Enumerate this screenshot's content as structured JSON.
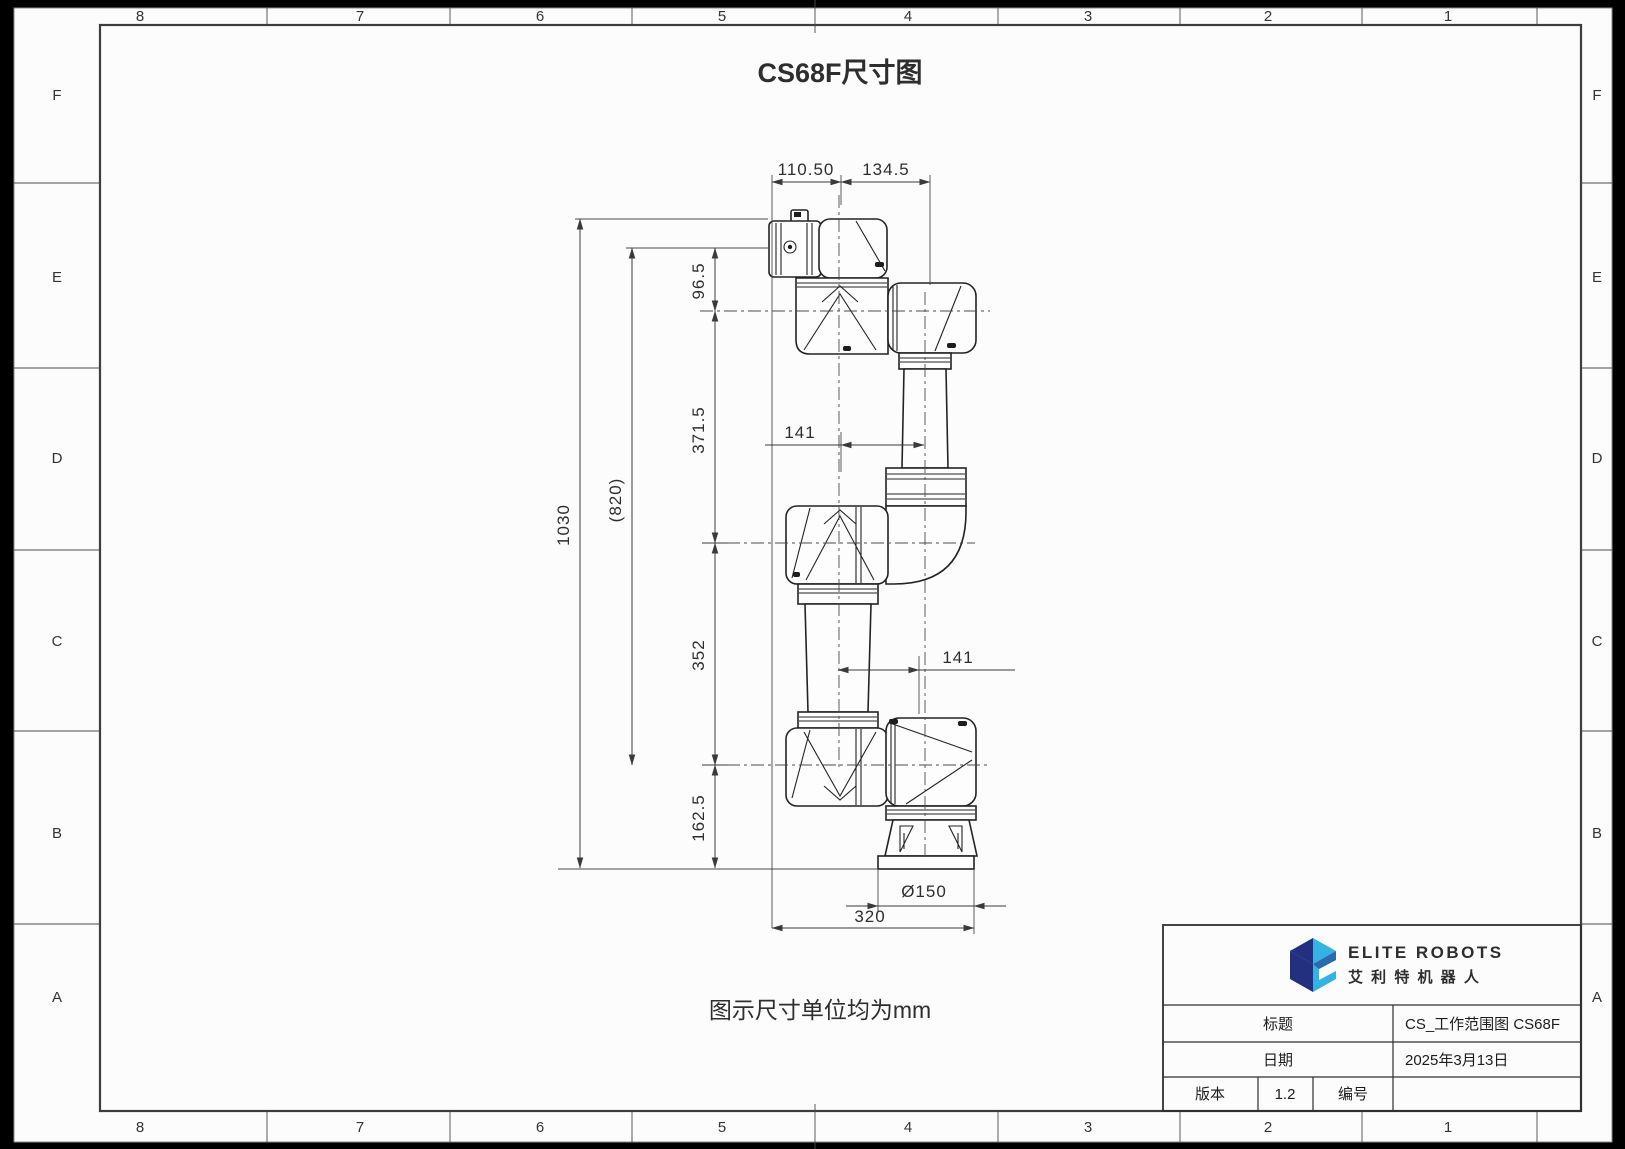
{
  "title": "CS68F尺寸图",
  "note": "图示尺寸单位均为mm",
  "grid": {
    "cols": [
      "8",
      "7",
      "6",
      "5",
      "4",
      "3",
      "2",
      "1"
    ],
    "rows": [
      "F",
      "E",
      "D",
      "C",
      "B",
      "A"
    ]
  },
  "dims": {
    "top_left": "110.50",
    "top_right": "134.5",
    "height_total": "1030",
    "height_ref": "(820)",
    "seg_top": "96.5",
    "seg_upper": "371.5",
    "seg_lower": "352",
    "seg_base": "162.5",
    "offset_upper": "141",
    "offset_lower": "141",
    "base_diameter": "Ø150",
    "base_span": "320"
  },
  "title_block": {
    "brand_en": "ELITE ROBOTS",
    "brand_cn": "艾 利 特 机 器 人",
    "label_title": "标题",
    "value_title": "CS_工作范围图 CS68F",
    "label_date": "日期",
    "value_date": "2025年3月13日",
    "label_version": "版本",
    "value_version": "1.2",
    "label_number": "编号",
    "value_number": ""
  },
  "colors": {
    "paper": "#fcfcfc",
    "line": "#2e2e2e",
    "logo_dark": "#22307f",
    "logo_light": "#35b2e3"
  }
}
